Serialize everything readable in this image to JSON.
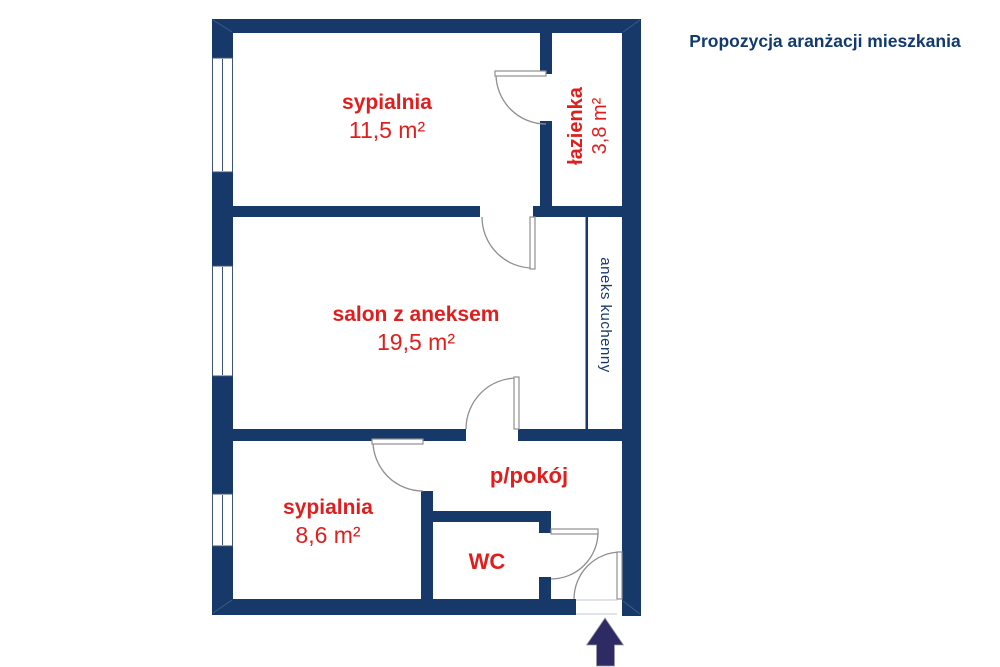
{
  "header": {
    "title": "Propozycja aranżacji mieszkania"
  },
  "rooms": [
    {
      "name": "sypialnia",
      "area": "11,5 m²"
    },
    {
      "name": "łazienka",
      "area": "3,8 m²"
    },
    {
      "name": "salon z aneksem",
      "area": "19,5 m²"
    },
    {
      "name": "aneks kuchenny"
    },
    {
      "name": "sypialnia",
      "area": "8,6 m²"
    },
    {
      "name": "p/pokój"
    },
    {
      "name": "WC"
    }
  ],
  "icons": {
    "entrance_arrow": "up-arrow"
  },
  "colors": {
    "wall": "#17396a",
    "room_label": "#e11e1e",
    "title": "#123a6e",
    "arrow": "#2e2a64",
    "door_line": "#8f8f8f"
  }
}
